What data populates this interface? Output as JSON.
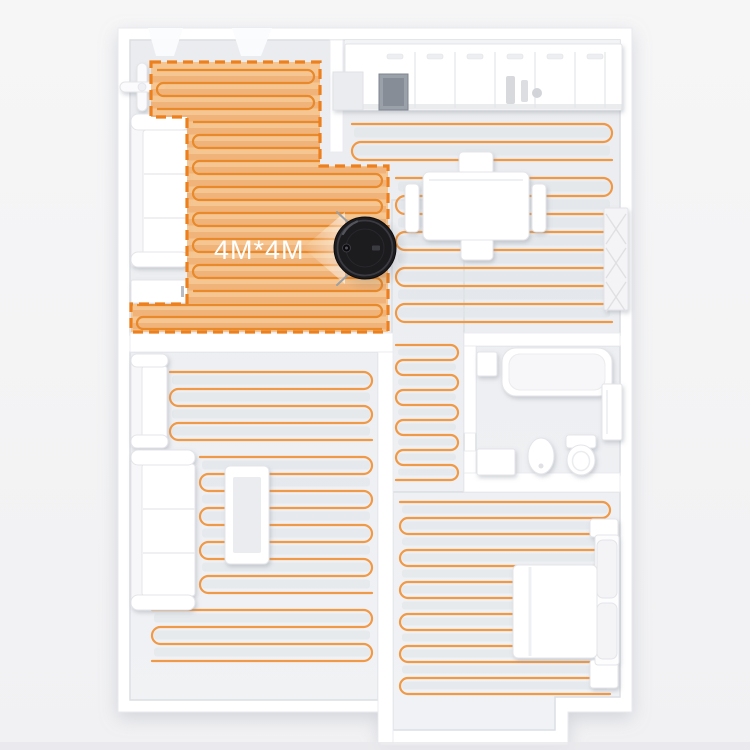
{
  "zone": {
    "label": "4M*4M"
  },
  "scene": {
    "areas": [
      "open-living-area",
      "kitchen",
      "dining-room",
      "living-room",
      "corridor",
      "bathroom",
      "bedroom"
    ],
    "device": "robot-vacuum-top-view"
  },
  "colors": {
    "background": "#f4f4f6",
    "floor": "#edeff2",
    "floor_stroke": "#dcdfe3",
    "wall": "#ffffff",
    "wall_stroke": "#e9eaee",
    "path_line": "#ef943c",
    "stripe": "#dfe3e8",
    "zone_fill": "#f5c289",
    "zone_stripe": "#eeb077",
    "zone_line": "#e8892b",
    "zone_border": "#ee7f1d",
    "furniture_fill": "#ffffff",
    "furniture_fill2": "#f6f6f8",
    "furniture_stroke": "#e4e5e9",
    "furniture_inner": "#ebecef",
    "dark_fixture": "#9ba1a9",
    "dark_fixture2": "#878d96",
    "robot_body": "#1c1c1f",
    "robot_edge": "#0d0d0f",
    "robot_ring": "#3a3a41",
    "robot_highlight": "#54545c",
    "whisker": "#9aa0a6",
    "label": "#ffffff",
    "bottom_band": "#e9e9ec"
  }
}
